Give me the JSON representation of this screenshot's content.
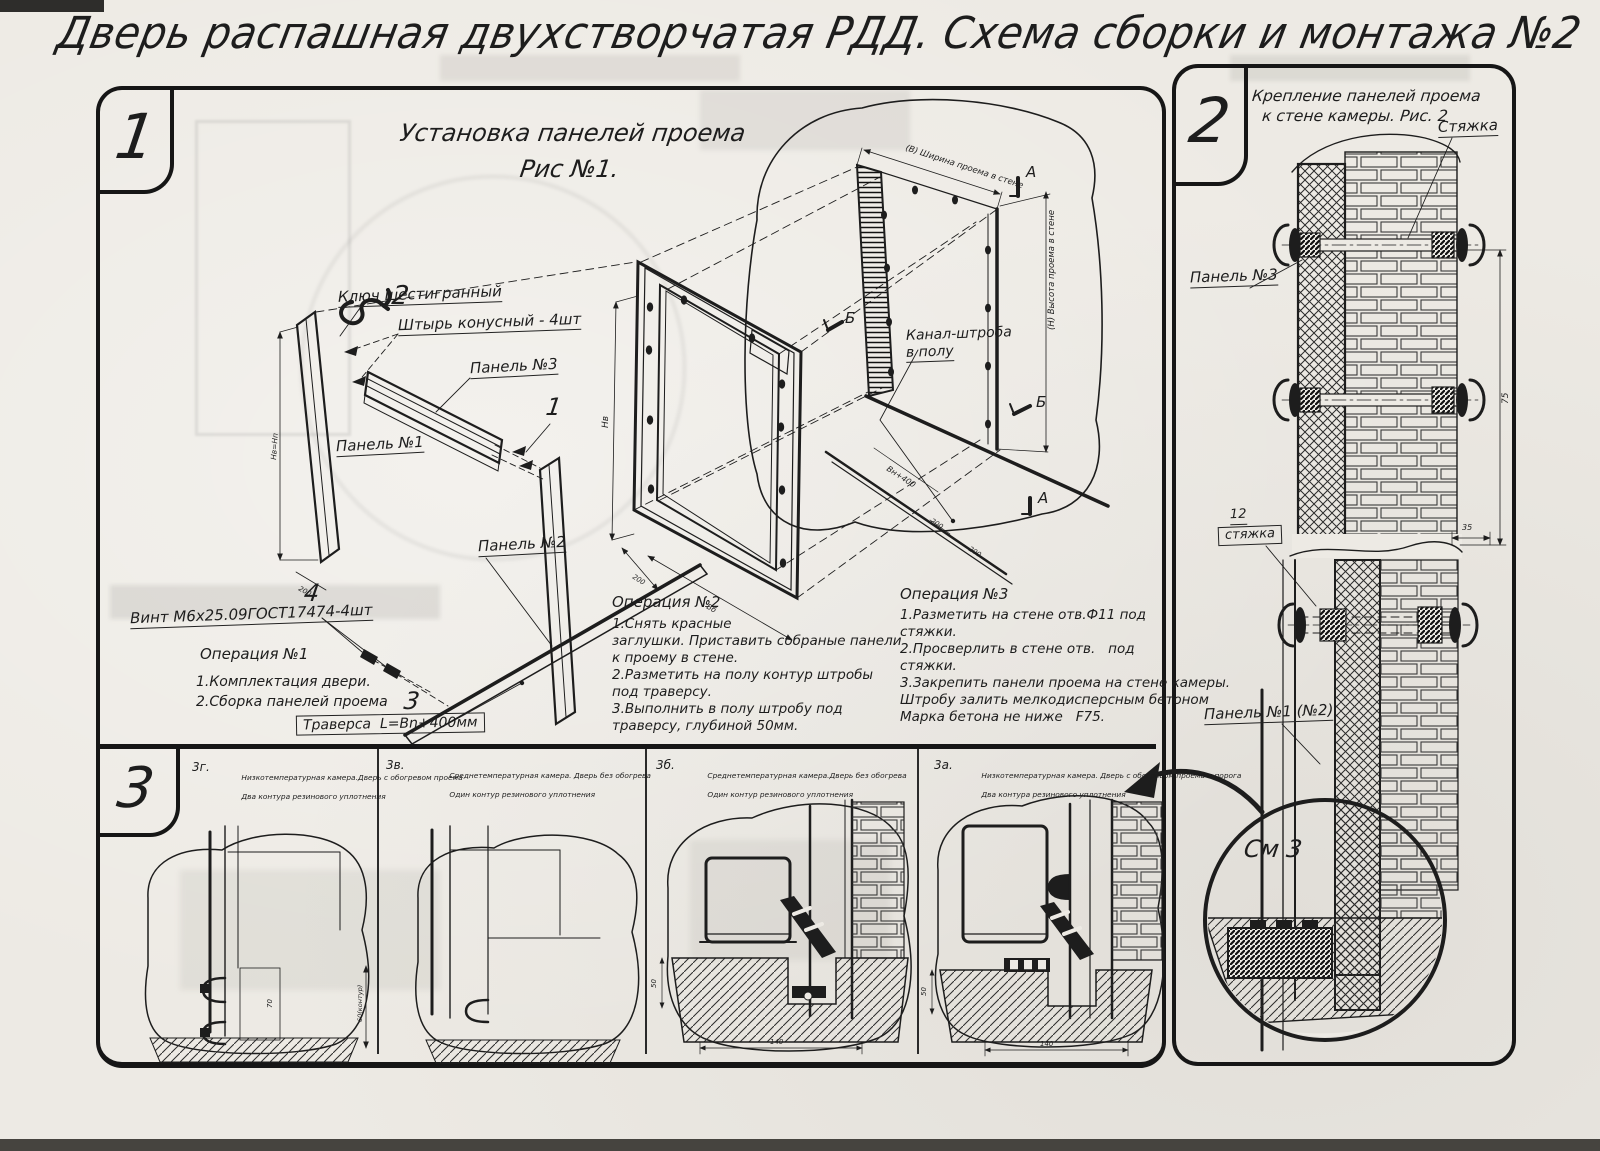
{
  "title": "Дверь распашная двухстворчатая РДД.  Схема сборки и монтажа №2",
  "colors": {
    "ink": "#1d1d1d",
    "paper": "#edeae4"
  },
  "section1": {
    "number": "1",
    "title_line1": "Установка панелей проема",
    "title_line2": "Рис №1.",
    "labels": {
      "hex_key": "Ключ шестигранный",
      "pin_num": "2",
      "pin": "Штырь конусный - 4шт",
      "panel3": "Панель №3",
      "one": "1",
      "panel1": "Панель №1",
      "panel2": "Панель №2",
      "screw_num": "4",
      "screw": "Винт М6х25.09ГОСТ17474-4шт",
      "traverse_num": "3",
      "traverse": "Траверса  L=Bn+400мм",
      "channel1": "Канал-штроба",
      "channel2": "в полу",
      "marker_a": "А",
      "marker_b": "Б"
    },
    "dims": {
      "width_note": "(В) Ширина проема в стене",
      "height_note": "(Н) Высота проема в стене",
      "vn400": "Вн+400",
      "nv": "Нв",
      "nvnp": "Нв=Нп",
      "d200": "200",
      "vb": "Вб"
    },
    "op1": {
      "title": "Операция №1",
      "lines": [
        "1.Комплектация двери.",
        "2.Сборка панелей проема"
      ]
    },
    "op2": {
      "title": "Операция №2",
      "lines": [
        "1.Снять красные",
        "заглушки. Приставить собраные панели",
        "к проему в стене.",
        "2.Разметить на полу контур штробы",
        "под траверсу.",
        "3.Выполнить в полу штробу под",
        "траверсу, глубиной 50мм."
      ]
    },
    "op3": {
      "title": "Операция №3",
      "lines": [
        "1.Разметить на стене отв.Ф11 под",
        "стяжки.",
        "2.Просверлить в стене отв.   под",
        "стяжки.",
        "3.Закрепить панели проема на стене камеры.",
        "Штробу залить мелкодисперсным бетоном",
        "Марка бетона не ниже   F75."
      ]
    }
  },
  "section2": {
    "number": "2",
    "title_line1": "Крепление панелей проема",
    "title_line2": "к стене камеры. Рис. 2",
    "labels": {
      "tie": "Стяжка",
      "panel3": "Панель №3",
      "tie12_num": "12",
      "tie12": "стяжка",
      "panel1": "Панель №1 (№2)",
      "see": "См 3"
    },
    "dims": {
      "d75": "75",
      "d35": "35"
    }
  },
  "section3": {
    "number": "3",
    "panels": [
      {
        "code": "3г.",
        "cap1": "Низкотемпературная камера.Дверь с обогревом проема",
        "cap2": "Два контура резинового уплотнения"
      },
      {
        "code": "3в.",
        "cap1": "Среднетемпературная камера. Дверь без обогрева",
        "cap2": "Один контур резинового уплотнения"
      },
      {
        "code": "3б.",
        "cap1": "Среднетемпературная камера.Дверь без обогрева",
        "cap2": "Один контур резинового уплотнения"
      },
      {
        "code": "3а.",
        "cap1": "Низкотемпературная камера. Дверь с обогревом проема и порога",
        "cap2": "Два контура резинового уплотнения"
      }
    ],
    "dims": {
      "d50": "50",
      "d140": "140",
      "d70": "70",
      "d60": "60(контур)"
    }
  }
}
